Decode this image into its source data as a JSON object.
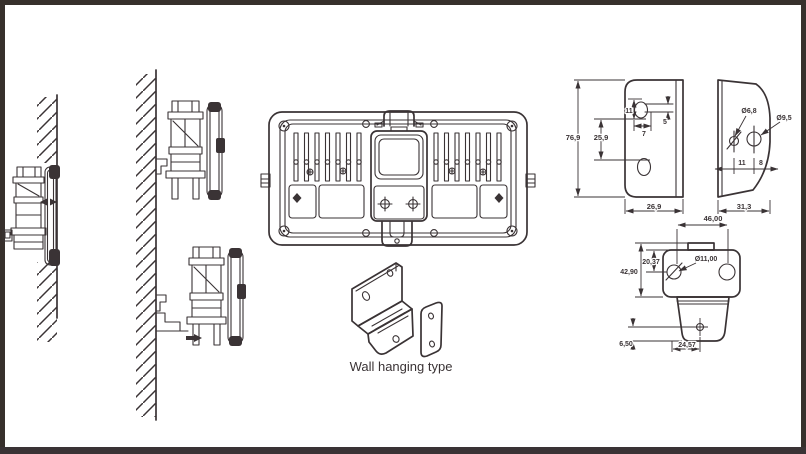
{
  "colors": {
    "background": "#ffffff",
    "line": "#3a3335",
    "frame": "#37302c"
  },
  "figures": {
    "caption": "Wall hanging type",
    "plate_front": {
      "height": "76,9",
      "hole_offset": "25,9",
      "slot_offset": "11",
      "slot_width": "7",
      "slot_gap": "5",
      "width": "26,9"
    },
    "plate_side": {
      "small_hole": "Ø6,8",
      "large_hole": "Ø9,5",
      "offset_left": "11",
      "offset_right": "8",
      "width": "31,3"
    },
    "bracket_top": {
      "hole_spacing": "46,00",
      "hole_offset": "20,37",
      "height": "42,90",
      "hole_diameter": "Ø11,00",
      "foot_hole_height": "6,50",
      "foot_hole_spacing": "24,57"
    }
  }
}
